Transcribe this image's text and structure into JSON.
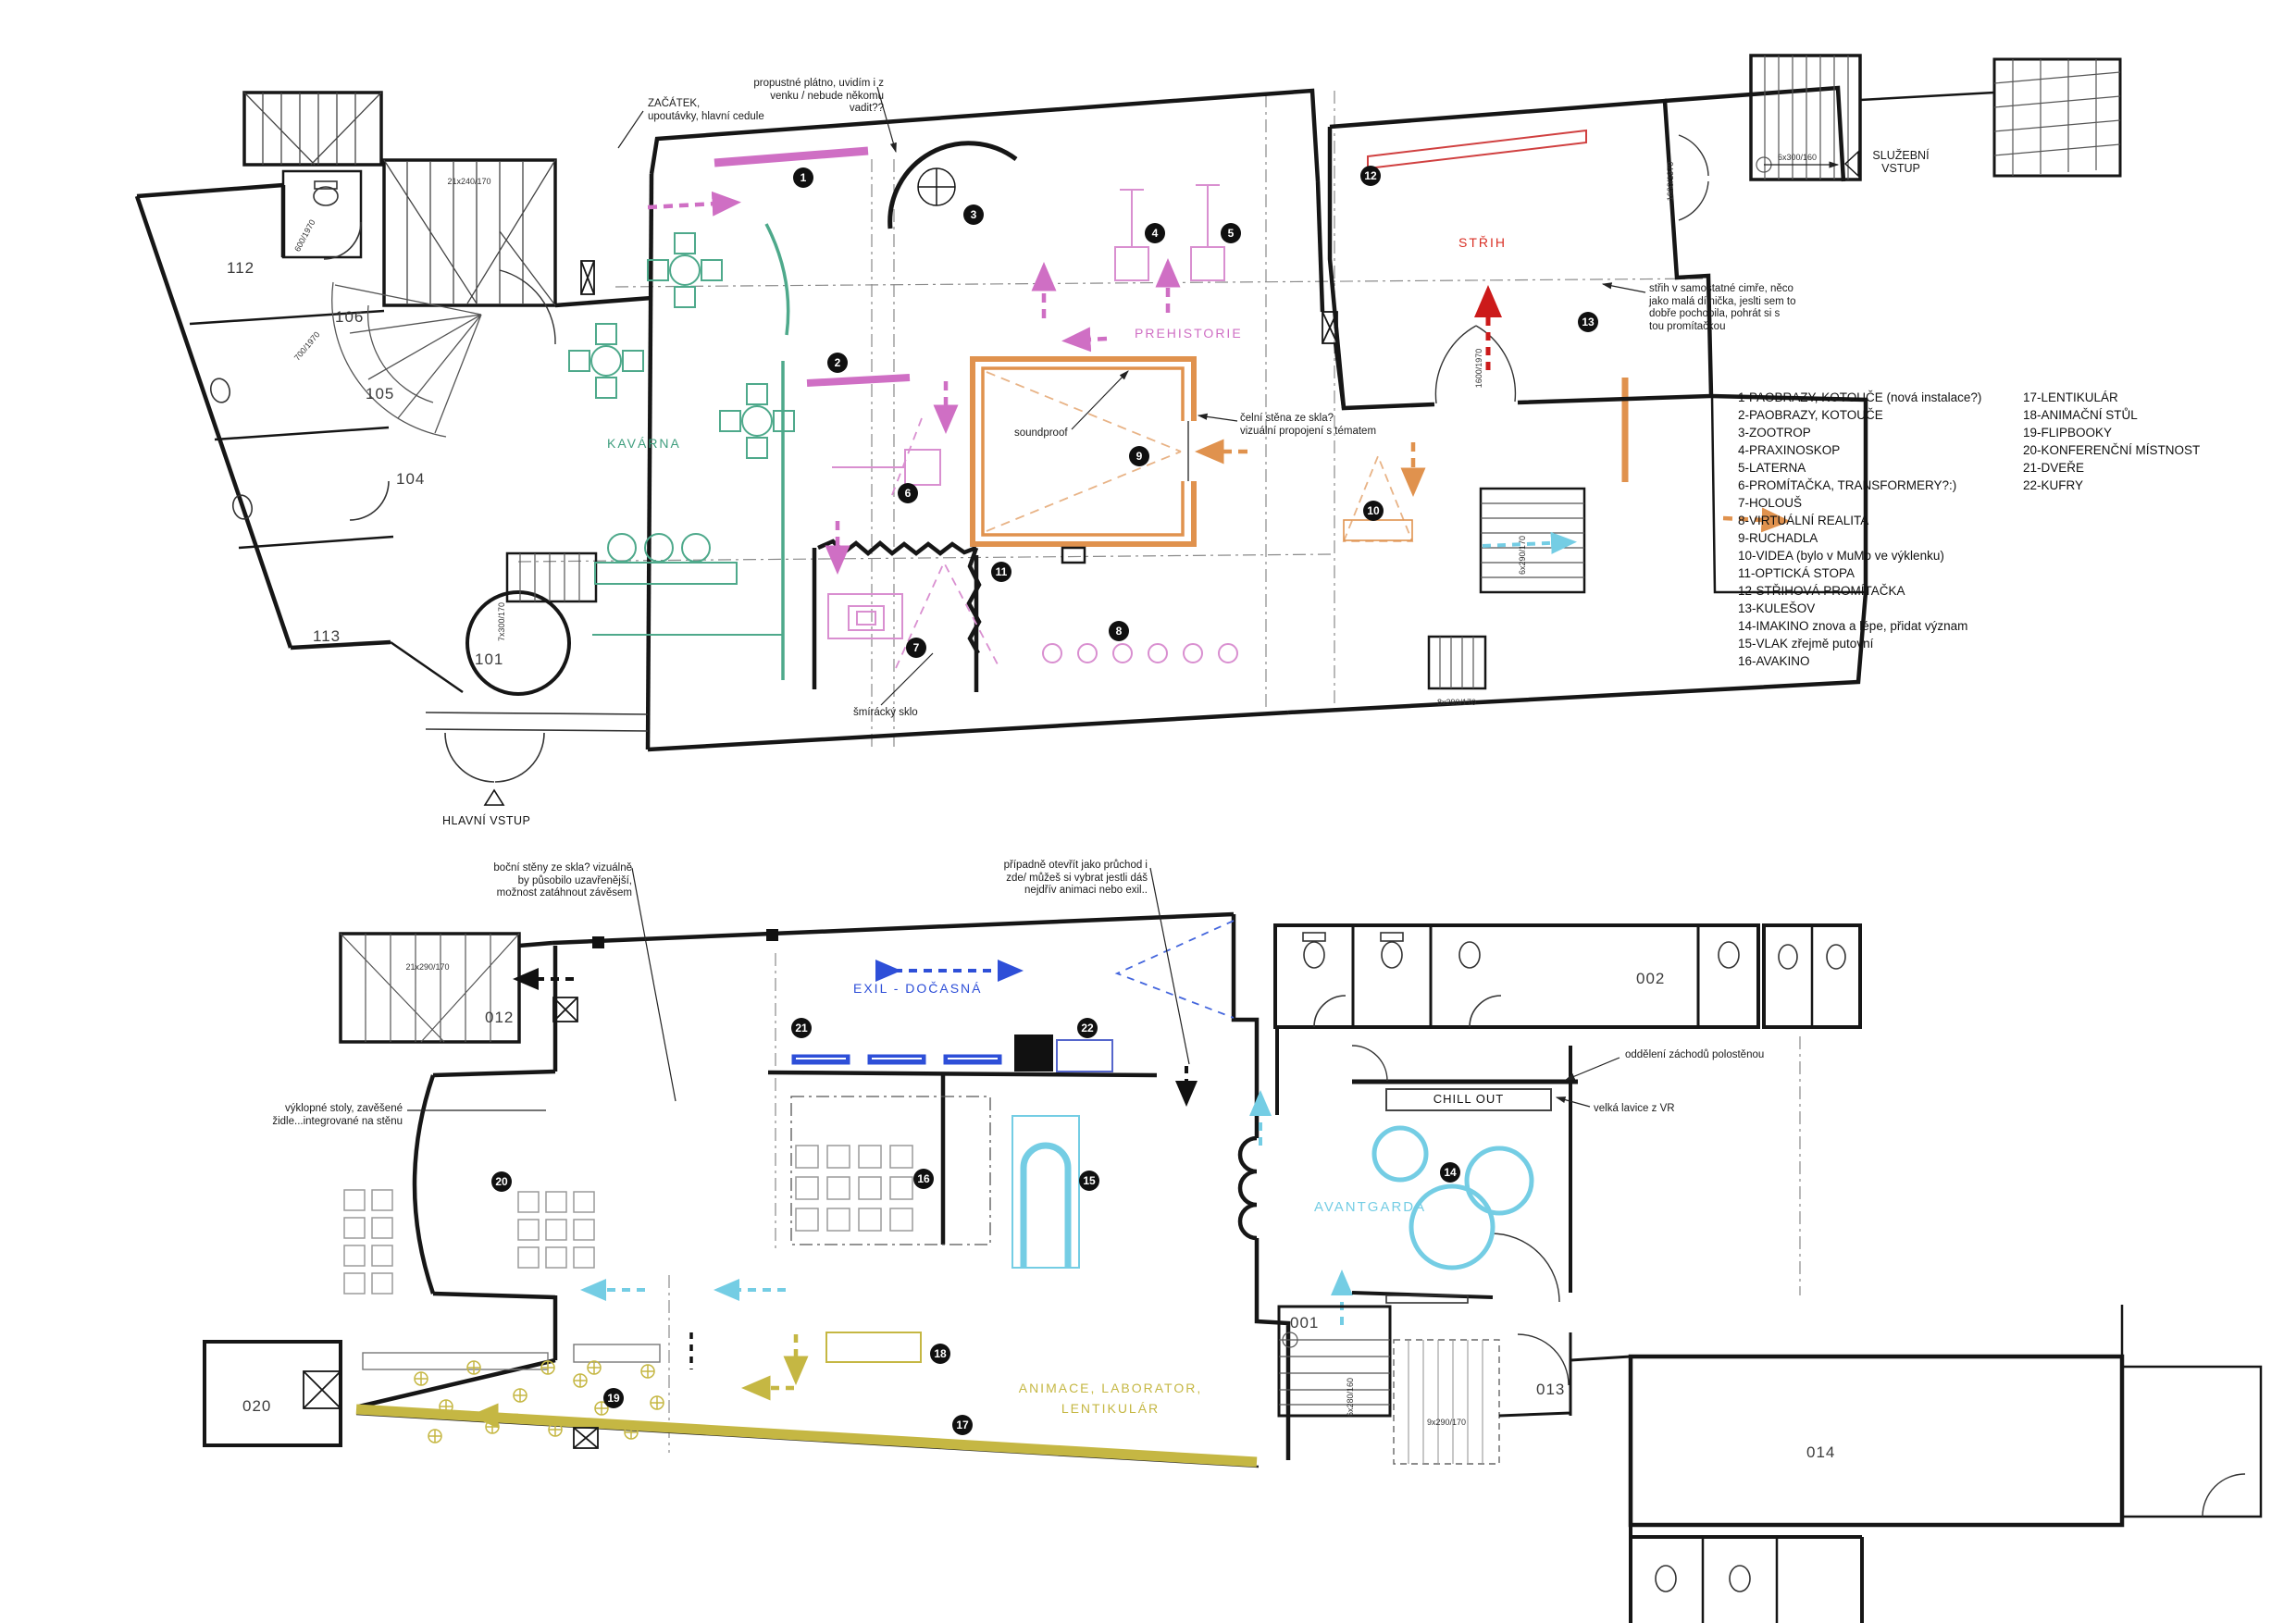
{
  "legend": {
    "column1": [
      "1-PAOBRAZY, KOTOUČE (nová instalace?)",
      "2-PAOBRAZY, KOTOUČE",
      "3-ZOOTROP",
      "4-PRAXINOSKOP",
      "5-LATERNA",
      "6-PROMÍTAČKA, TRANSFORMERY?:)",
      "7-HOLOUŠ",
      "8-VIRTUÁLNÍ REALITA",
      "9-RUCHADLA",
      "10-VIDEA (bylo  v MuMo ve výklenku)",
      "11-OPTICKÁ STOPA",
      "12-STŘIHOVÁ PROMÍTAČKA",
      "13-KULEŠOV",
      "14-IMAKINO znova a lépe, přidat význam",
      "15-VLAK zřejmě putovní",
      "16-AVAKINO"
    ],
    "column2": [
      "17-LENTIKULÁR",
      "18-ANIMAČNÍ STŮL",
      "19-FLIPBOOKY",
      "20-KONFERENČNÍ MÍSTNOST",
      "21-DVEŘE",
      "22-KUFRY"
    ]
  },
  "upper": {
    "rooms": {
      "kavarna": "KAVÁRNA",
      "prehistorie": "PREHISTORIE",
      "strih": "STŘIH"
    },
    "room_numbers": {
      "r112": "112",
      "r106": "106",
      "r105": "105",
      "r104": "104",
      "r113": "113",
      "r101": "101"
    },
    "annotations": {
      "zacatek": "ZAČÁTEK,\nupoutávky, hlavní cedule",
      "propustne": "propustné plátno, uvidím i z\nvenku / nebude někomu\nvadit??",
      "sluzebni": "SLUŽEBNÍ\nVSTUP",
      "hlavni": "HLAVNÍ VSTUP",
      "strih_note": "střih v samostatné cimře, něco\njako malá dílnička, jeslti sem to\ndobře pochopila, pohrát si s\ntou promítačkou",
      "celni": "čelní stěna ze skla?\nvizuální propojení s tématem",
      "smiracky": "šmírácký sklo",
      "soundproof": "soundproof"
    }
  },
  "lower": {
    "rooms": {
      "exil": "EXIL - DOČASNÁ",
      "avantgarda": "AVANTGARDA",
      "animace": "ANIMACE, LABORATOR,\nLENTIKULÁR",
      "chill_out": "CHILL OUT"
    },
    "room_numbers": {
      "r012": "012",
      "r020": "020",
      "r002": "002",
      "r001": "001",
      "r013": "013",
      "r014": "014"
    },
    "annotations": {
      "bocni": "boční stěny ze skla? vizuálně\nby působilo uzavřenější,\nmožnost zatáhnout závěsem",
      "pripadne": "případně otevřít jako průchod i\nzde/ můžeš si vybrat jestli dáš\nnejdřív animaci nebo exil..",
      "vyklopne": "výklopné stoly, zavěšené\nžidle...integrované na stěnu",
      "oddeleni": "oddělení záchodů polostěnou",
      "lavice": "velká lavice z VR"
    }
  },
  "stair_labels": {
    "s21x240": "21x240/170",
    "s6x300": "6x300/160",
    "s7x300": "7x300/170",
    "s6x290": "6x290/170",
    "s8x290": "8x290/170",
    "s21x290": "21x290/170",
    "s6x280": "6x280/160",
    "s9x290": "9x290/170"
  },
  "door_labels": {
    "d600": "600/1970",
    "d700": "700/1970",
    "d1600": "1600/1970"
  },
  "badges": {
    "b1": "1",
    "b2": "2",
    "b3": "3",
    "b4": "4",
    "b5": "5",
    "b6": "6",
    "b7": "7",
    "b8": "8",
    "b9": "9",
    "b10": "10",
    "b11": "11",
    "b12": "12",
    "b13": "13",
    "b14": "14",
    "b15": "15",
    "b16": "16",
    "b17": "17",
    "b18": "18",
    "b19": "19",
    "b20": "20",
    "b21": "21",
    "b22": "22"
  },
  "colors": {
    "wall": "#161616",
    "magenta": "#cf6fc4",
    "green": "#4ea98b",
    "orange": "#e0924e",
    "red": "#d93025",
    "blue": "#2e4fd8",
    "cyan": "#74cde4",
    "olive": "#c5b743"
  }
}
